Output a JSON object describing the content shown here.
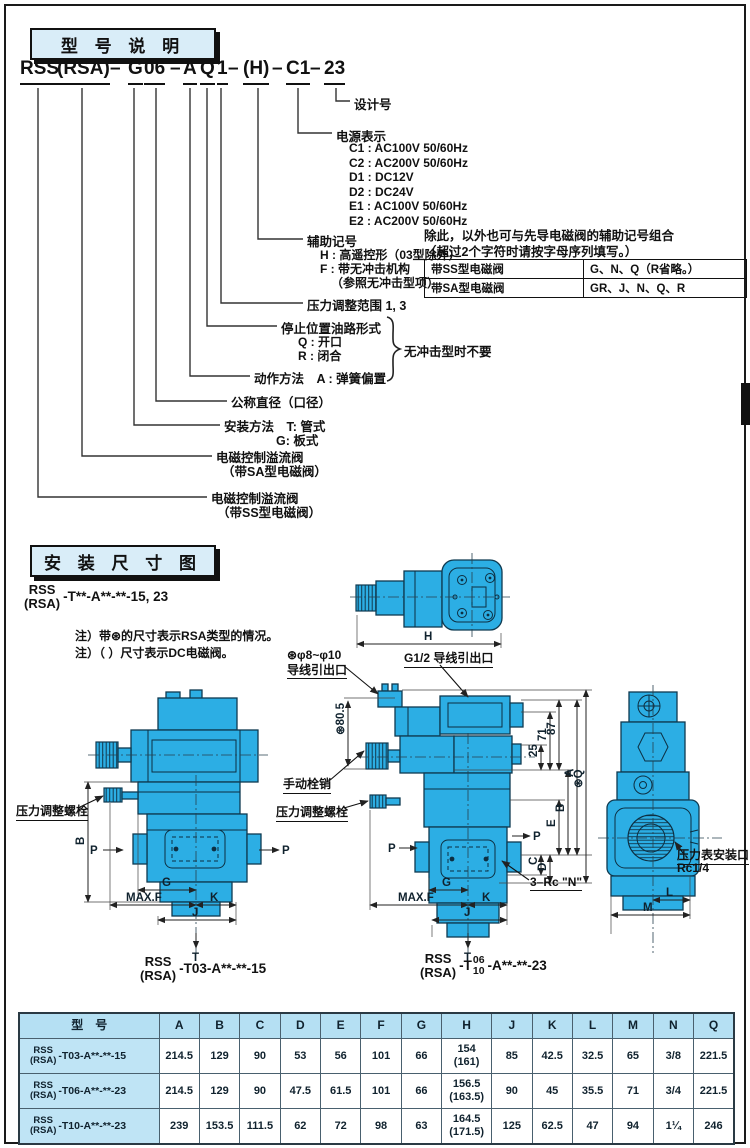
{
  "sections": {
    "model_title": "型 号 说 明",
    "dims_title": "安 装 尺 寸 图"
  },
  "model_code": {
    "segments": [
      "RSS",
      "(RSA)",
      "–",
      "G",
      "06",
      "–",
      "A",
      "Q",
      "1",
      "–",
      "(H)",
      "–",
      "C1",
      "–",
      "23"
    ]
  },
  "tree": {
    "design_no": "设计号",
    "power_label": "电源表示",
    "power_options": [
      "C1 : AC100V 50/60Hz",
      "C2 : AC200V 50/60Hz",
      "D1 : DC12V",
      "D2 : DC24V",
      "E1 : AC100V 50/60Hz",
      "E2 : AC200V 50/60Hz"
    ],
    "aux_label": "辅助记号",
    "aux_h": "H : 高遥控形（03型除外）",
    "aux_f": "F : 带无冲击机构",
    "aux_f2": "（参照无冲击型项）",
    "pressure_range": "压力调整范围 1, 3",
    "stop_label": "停止位置油路形式",
    "stop_q": "Q : 开口",
    "stop_r": "R : 闭合",
    "brace_note": "无冲击型时不要",
    "action": "动作方法　A : 弹簧偏置",
    "diameter": "公称直径（口径）",
    "mount_t": "安装方法　T: 管式",
    "mount_g": "G: 板式",
    "sa1": "电磁控制溢流阀",
    "sa2": "（带SA型电磁阀）",
    "ss1": "电磁控制溢流阀",
    "ss2": "（带SS型电磁阀）"
  },
  "aux_note": {
    "line1": "除此，以外也可与先导电磁阀的辅助记号组合",
    "line2": "（超过2个字符时请按字母序列填写。）",
    "rows": [
      [
        "带SS型电磁阀",
        "G、N、Q（R省略。）"
      ],
      [
        "带SA型电磁阀",
        "GR、J、N、Q、R"
      ]
    ]
  },
  "install": {
    "code_top": "RSS",
    "code_bottom": "(RSA)",
    "code_suffix": "-T**-A**-**-15, 23",
    "note1": "注）带⊛的尺寸表示RSA类型的情况。",
    "note2": "注）（ ）尺寸表示DC电磁阀。",
    "labels": {
      "adj_bolt_left": "压力调整螺栓",
      "wire1a": "⊛φ8~φ10",
      "wire1b": "导线引出口",
      "wire2": "G1/2 导线引出口",
      "d805": "⊛80.5",
      "manual_pin": "手动栓销",
      "adj_bolt_center": "压力调整螺栓",
      "rc_n": "3–Rc \"N\"",
      "gauge1": "压力表安装口",
      "gauge2": "Rc1/4"
    },
    "dims": {
      "h": "H",
      "b": "B",
      "p": "P",
      "g": "G",
      "maxf": "MAX.F",
      "k": "K",
      "j": "J",
      "t": "T",
      "n25": "25",
      "n71": "71",
      "n87": "87",
      "a": "A",
      "q": "⊛Q",
      "e": "E",
      "c": "C",
      "d": "D",
      "l": "L",
      "m": "M"
    },
    "code_left": {
      "top": "RSS",
      "bottom": "(RSA)",
      "suffix": "-T03-A**-**-15"
    },
    "code_right": {
      "top": "RSS",
      "bottom": "(RSA)",
      "t": "-T",
      "s_top": "06",
      "s_bottom": "10",
      "suffix": "-A**-**-23"
    }
  },
  "table": {
    "headers": [
      "型　号",
      "A",
      "B",
      "C",
      "D",
      "E",
      "F",
      "G",
      "H",
      "J",
      "K",
      "L",
      "M",
      "N",
      "Q"
    ],
    "row_models": [
      {
        "top": "RSS",
        "bottom": "(RSA)",
        "suffix": "-T03-A**-**-15"
      },
      {
        "top": "RSS",
        "bottom": "(RSA)",
        "suffix": "-T06-A**-**-23"
      },
      {
        "top": "RSS",
        "bottom": "(RSA)",
        "suffix": "-T10-A**-**-23"
      }
    ],
    "rows": [
      [
        "214.5",
        "129",
        "90",
        "53",
        "56",
        "101",
        "66",
        "154\n(161)",
        "85",
        "42.5",
        "32.5",
        "65",
        "3/8",
        "221.5"
      ],
      [
        "214.5",
        "129",
        "90",
        "47.5",
        "61.5",
        "101",
        "66",
        "156.5\n(163.5)",
        "90",
        "45",
        "35.5",
        "71",
        "3/4",
        "221.5"
      ],
      [
        "239",
        "153.5",
        "111.5",
        "62",
        "72",
        "98",
        "63",
        "164.5\n(171.5)",
        "125",
        "62.5",
        "47",
        "94",
        "1¼",
        "246"
      ]
    ]
  },
  "colors": {
    "valve_fill": "#2caee4",
    "panel_blue": "#d9edf8",
    "table_header": "#b5e0f3"
  }
}
